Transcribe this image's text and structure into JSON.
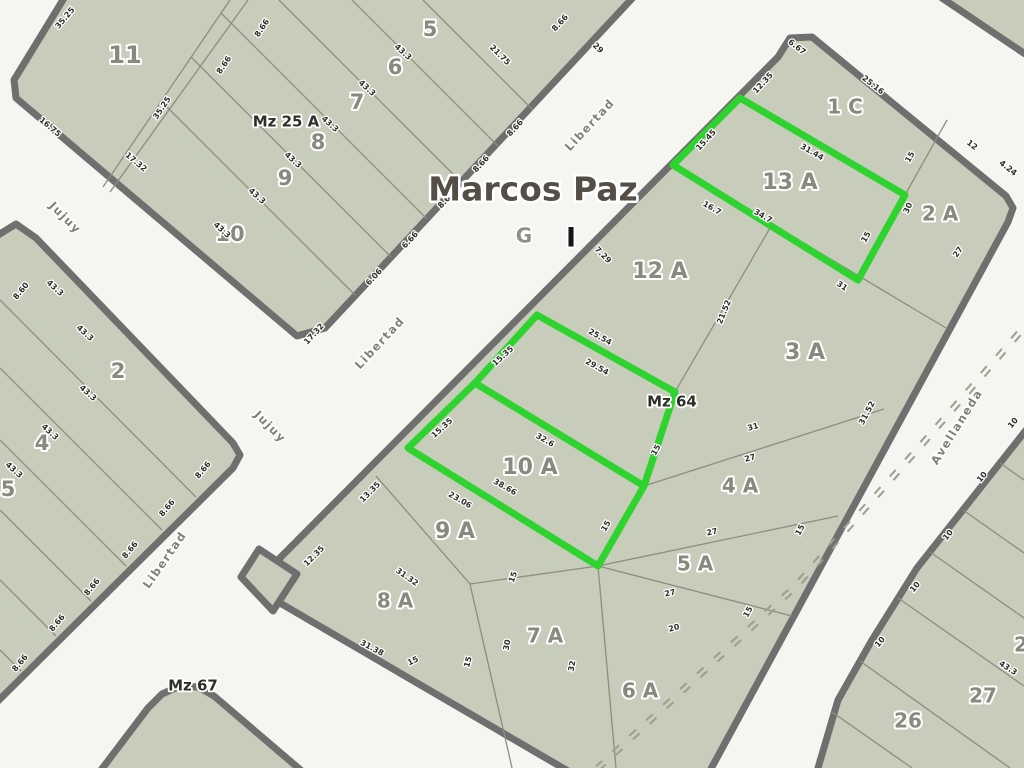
{
  "map_title": {
    "text": "Marcos Paz",
    "x": 533,
    "y": 191
  },
  "overlay_letters": {
    "g": "G",
    "gx": 524,
    "gy": 237,
    "i": "I",
    "ix": 571,
    "iy": 239
  },
  "colors": {
    "street_bg": "#f5f5f2",
    "block_fill": "#c8ccba",
    "block_border": "#6f6f6f",
    "lot_line": "#8d8d81",
    "lot_label": "#868b7d",
    "measurement": "#2e2e28",
    "mz_label": "#2e302a",
    "street_label": "#7e8377",
    "title_color": "#544e46",
    "g_color": "#8f8f8b",
    "i_color": "#161616",
    "green": "#2fd32f",
    "railway": "#9aa08c"
  },
  "blocks": [
    {
      "name": "mz-25a",
      "points": [
        [
          69,
          -10
        ],
        [
          640,
          -10
        ],
        [
          325,
          328
        ],
        [
          297,
          336
        ],
        [
          16,
          98
        ],
        [
          14,
          80
        ]
      ]
    },
    {
      "name": "left-bottom-block",
      "points": [
        [
          -10,
          240
        ],
        [
          16,
          224
        ],
        [
          36,
          238
        ],
        [
          233,
          443
        ],
        [
          240,
          455
        ],
        [
          233,
          468
        ],
        [
          0,
          699
        ],
        [
          -10,
          709
        ]
      ]
    },
    {
      "name": "mz-64",
      "points": [
        [
          778,
          57
        ],
        [
          790,
          38
        ],
        [
          812,
          37
        ],
        [
          1006,
          196
        ],
        [
          1013,
          208
        ],
        [
          1008,
          222
        ],
        [
          706,
          778
        ],
        [
          580,
          778
        ],
        [
          268,
          596
        ],
        [
          258,
          584
        ],
        [
          266,
          572
        ]
      ]
    },
    {
      "name": "mz-67",
      "points": [
        [
          95,
          778
        ],
        [
          148,
          708
        ],
        [
          162,
          694
        ],
        [
          180,
          686
        ],
        [
          198,
          687
        ],
        [
          214,
          696
        ],
        [
          310,
          778
        ]
      ]
    },
    {
      "name": "top-right-corner-block",
      "points": [
        [
          930,
          -10
        ],
        [
          1034,
          -10
        ],
        [
          1034,
          60
        ]
      ]
    },
    {
      "name": "bottom-right-block",
      "points": [
        [
          1034,
          420
        ],
        [
          917,
          568
        ],
        [
          872,
          640
        ],
        [
          838,
          700
        ],
        [
          818,
          768
        ],
        [
          814,
          778
        ],
        [
          1034,
          778
        ]
      ]
    },
    {
      "name": "street-fork-sliver",
      "points": [
        [
          259,
          549
        ],
        [
          297,
          574
        ],
        [
          273,
          611
        ],
        [
          241,
          577
        ]
      ]
    }
  ],
  "lot_lines": [
    [
      230,
      0,
      103,
      187
    ],
    [
      248,
      0,
      110,
      192
    ],
    [
      423,
      0,
      533,
      110
    ],
    [
      352,
      0,
      498,
      146
    ],
    [
      279,
      0,
      462,
      183
    ],
    [
      221,
      13,
      427,
      219
    ],
    [
      191,
      57,
      391,
      257
    ],
    [
      161,
      101,
      355,
      295
    ],
    [
      0,
      300,
      196,
      497
    ],
    [
      0,
      368,
      162,
      530
    ],
    [
      0,
      440,
      126,
      566
    ],
    [
      0,
      510,
      91,
      601
    ],
    [
      0,
      580,
      56,
      636
    ],
    [
      0,
      650,
      21,
      671
    ],
    [
      673,
      165,
      946,
      328
    ],
    [
      740,
      98,
      673,
      165
    ],
    [
      740,
      98,
      905,
      195
    ],
    [
      905,
      195,
      858,
      280
    ],
    [
      947,
      120,
      905,
      195
    ],
    [
      770,
      228,
      675,
      392
    ],
    [
      537,
      315,
      675,
      392
    ],
    [
      675,
      392,
      644,
      486
    ],
    [
      475,
      383,
      644,
      486
    ],
    [
      537,
      315,
      408,
      448
    ],
    [
      408,
      448,
      598,
      566
    ],
    [
      644,
      486,
      598,
      566
    ],
    [
      644,
      486,
      884,
      409
    ],
    [
      598,
      566,
      838,
      516
    ],
    [
      598,
      566,
      792,
      616
    ],
    [
      376,
      476,
      470,
      584
    ],
    [
      470,
      584,
      598,
      566
    ],
    [
      470,
      584,
      512,
      768
    ],
    [
      598,
      566,
      616,
      768
    ],
    [
      1000,
      463,
      1034,
      487
    ],
    [
      963,
      510,
      1034,
      560
    ],
    [
      930,
      552,
      1034,
      625
    ],
    [
      898,
      598,
      1034,
      693
    ],
    [
      860,
      661,
      1010,
      768
    ],
    [
      832,
      712,
      912,
      768
    ]
  ],
  "green_highlight": {
    "polygons": [
      [
        [
          740,
          98
        ],
        [
          905,
          195
        ],
        [
          858,
          280
        ],
        [
          673,
          165
        ]
      ],
      [
        [
          537,
          315
        ],
        [
          675,
          392
        ],
        [
          644,
          486
        ],
        [
          598,
          566
        ],
        [
          408,
          448
        ],
        [
          475,
          383
        ]
      ]
    ],
    "segments": [
      [
        475,
        383,
        644,
        486
      ]
    ]
  },
  "railway": {
    "points": [
      [
        1034,
        316
      ],
      [
        923,
        443
      ],
      [
        795,
        587
      ],
      [
        598,
        768
      ]
    ]
  },
  "labels": {
    "mz": [
      {
        "t": "Mz 25 A",
        "x": 286,
        "y": 122
      },
      {
        "t": "Mz 64",
        "x": 672,
        "y": 402
      },
      {
        "t": "Mz 67",
        "x": 193,
        "y": 686
      }
    ],
    "lots": [
      {
        "t": "11",
        "x": 125,
        "y": 56,
        "s": 24
      },
      {
        "t": "5",
        "x": 430,
        "y": 30,
        "s": 21
      },
      {
        "t": "6",
        "x": 395,
        "y": 68,
        "s": 21
      },
      {
        "t": "7",
        "x": 357,
        "y": 103,
        "s": 21
      },
      {
        "t": "8",
        "x": 318,
        "y": 143,
        "s": 21
      },
      {
        "t": "9",
        "x": 285,
        "y": 179,
        "s": 21
      },
      {
        "t": "10",
        "x": 230,
        "y": 235,
        "s": 21
      },
      {
        "t": "2",
        "x": 118,
        "y": 372,
        "s": 21
      },
      {
        "t": "4",
        "x": 42,
        "y": 444,
        "s": 21
      },
      {
        "t": "5",
        "x": 8,
        "y": 490,
        "s": 21
      },
      {
        "t": "1 C",
        "x": 845,
        "y": 108,
        "s": 20
      },
      {
        "t": "13 A",
        "x": 790,
        "y": 183,
        "s": 22
      },
      {
        "t": "2 A",
        "x": 940,
        "y": 215,
        "s": 20
      },
      {
        "t": "12 A",
        "x": 660,
        "y": 272,
        "s": 22
      },
      {
        "t": "3 A",
        "x": 805,
        "y": 353,
        "s": 22
      },
      {
        "t": "10 A",
        "x": 530,
        "y": 468,
        "s": 22
      },
      {
        "t": "4 A",
        "x": 740,
        "y": 487,
        "s": 20
      },
      {
        "t": "9 A",
        "x": 455,
        "y": 532,
        "s": 22
      },
      {
        "t": "5 A",
        "x": 695,
        "y": 565,
        "s": 20
      },
      {
        "t": "8 A",
        "x": 395,
        "y": 602,
        "s": 20
      },
      {
        "t": "7 A",
        "x": 545,
        "y": 637,
        "s": 20
      },
      {
        "t": "6 A",
        "x": 640,
        "y": 692,
        "s": 20
      },
      {
        "t": "26",
        "x": 908,
        "y": 722,
        "s": 20
      },
      {
        "t": "27",
        "x": 983,
        "y": 697,
        "s": 20
      },
      {
        "t": "2",
        "x": 1021,
        "y": 646,
        "s": 20
      }
    ],
    "streets": [
      {
        "t": "Libertad",
        "x": 590,
        "y": 125,
        "r": -47
      },
      {
        "t": "Libertad",
        "x": 380,
        "y": 343,
        "r": -47
      },
      {
        "t": "Libertad",
        "x": 165,
        "y": 560,
        "r": -55
      },
      {
        "t": "Jujuy",
        "x": 65,
        "y": 218,
        "r": 45
      },
      {
        "t": "Jujuy",
        "x": 270,
        "y": 427,
        "r": 45
      },
      {
        "t": "Avellaneda",
        "x": 957,
        "y": 427,
        "r": -58
      }
    ],
    "measurements": [
      {
        "t": "35.25",
        "x": 65,
        "y": 18,
        "r": -50
      },
      {
        "t": "35.25",
        "x": 162,
        "y": 108,
        "r": -56
      },
      {
        "t": "16.75",
        "x": 50,
        "y": 127,
        "r": 40
      },
      {
        "t": "17.32",
        "x": 136,
        "y": 162,
        "r": 40
      },
      {
        "t": "17.32",
        "x": 314,
        "y": 334,
        "r": -47
      },
      {
        "t": "8.66",
        "x": 262,
        "y": 28,
        "r": -56
      },
      {
        "t": "8.66",
        "x": 224,
        "y": 65,
        "r": -56
      },
      {
        "t": "8.66",
        "x": 560,
        "y": 23,
        "r": -47
      },
      {
        "t": "43.3",
        "x": 403,
        "y": 52,
        "r": 42
      },
      {
        "t": "43.3",
        "x": 367,
        "y": 88,
        "r": 42
      },
      {
        "t": "43.3",
        "x": 330,
        "y": 124,
        "r": 42
      },
      {
        "t": "43.3",
        "x": 293,
        "y": 160,
        "r": 42
      },
      {
        "t": "43.3",
        "x": 257,
        "y": 196,
        "r": 42
      },
      {
        "t": "43.3",
        "x": 222,
        "y": 230,
        "r": 42
      },
      {
        "t": "21.75",
        "x": 500,
        "y": 55,
        "r": 45
      },
      {
        "t": "29",
        "x": 598,
        "y": 48,
        "r": 45
      },
      {
        "t": "8.66",
        "x": 515,
        "y": 128,
        "r": -47
      },
      {
        "t": "8.66",
        "x": 481,
        "y": 164,
        "r": -47
      },
      {
        "t": "8.66",
        "x": 446,
        "y": 200,
        "r": -47
      },
      {
        "t": "6.66",
        "x": 410,
        "y": 240,
        "r": -47
      },
      {
        "t": "6.06",
        "x": 374,
        "y": 277,
        "r": -47
      },
      {
        "t": "8.60",
        "x": 21,
        "y": 291,
        "r": -50
      },
      {
        "t": "43.3",
        "x": 55,
        "y": 288,
        "r": 42
      },
      {
        "t": "43.3",
        "x": 85,
        "y": 333,
        "r": 42
      },
      {
        "t": "43.3",
        "x": 88,
        "y": 393,
        "r": 42
      },
      {
        "t": "43.3",
        "x": 50,
        "y": 432,
        "r": 42
      },
      {
        "t": "43.3",
        "x": 14,
        "y": 470,
        "r": 42
      },
      {
        "t": "8.66",
        "x": 203,
        "y": 470,
        "r": -50
      },
      {
        "t": "8.66",
        "x": 167,
        "y": 508,
        "r": -50
      },
      {
        "t": "8.66",
        "x": 130,
        "y": 550,
        "r": -50
      },
      {
        "t": "8.66",
        "x": 92,
        "y": 587,
        "r": -50
      },
      {
        "t": "8.66",
        "x": 57,
        "y": 623,
        "r": -50
      },
      {
        "t": "8.66",
        "x": 20,
        "y": 663,
        "r": -50
      },
      {
        "t": "6.67",
        "x": 797,
        "y": 47,
        "r": 38
      },
      {
        "t": "12.35",
        "x": 763,
        "y": 83,
        "r": -47
      },
      {
        "t": "25.16",
        "x": 873,
        "y": 85,
        "r": 38
      },
      {
        "t": "15.45",
        "x": 706,
        "y": 140,
        "r": -47
      },
      {
        "t": "31.44",
        "x": 812,
        "y": 152,
        "r": 30
      },
      {
        "t": "15",
        "x": 910,
        "y": 157,
        "r": -60
      },
      {
        "t": "12",
        "x": 972,
        "y": 145,
        "r": 38
      },
      {
        "t": "4.24",
        "x": 1008,
        "y": 168,
        "r": 38
      },
      {
        "t": "30",
        "x": 908,
        "y": 208,
        "r": -65
      },
      {
        "t": "16.7",
        "x": 712,
        "y": 208,
        "r": 30
      },
      {
        "t": "34.7",
        "x": 763,
        "y": 216,
        "r": 30
      },
      {
        "t": "15",
        "x": 866,
        "y": 237,
        "r": -60
      },
      {
        "t": "27",
        "x": 958,
        "y": 252,
        "r": -55
      },
      {
        "t": "7.29",
        "x": 603,
        "y": 255,
        "r": 45
      },
      {
        "t": "31",
        "x": 842,
        "y": 286,
        "r": 33
      },
      {
        "t": "21.52",
        "x": 724,
        "y": 312,
        "r": -68
      },
      {
        "t": "25.54",
        "x": 600,
        "y": 337,
        "r": 29
      },
      {
        "t": "29.54",
        "x": 597,
        "y": 367,
        "r": 29
      },
      {
        "t": "31.52",
        "x": 867,
        "y": 413,
        "r": -62
      },
      {
        "t": "15.35",
        "x": 503,
        "y": 356,
        "r": -42
      },
      {
        "t": "15.35",
        "x": 442,
        "y": 428,
        "r": -42
      },
      {
        "t": "32.6",
        "x": 545,
        "y": 440,
        "r": 30
      },
      {
        "t": "15",
        "x": 656,
        "y": 450,
        "r": -60
      },
      {
        "t": "31",
        "x": 753,
        "y": 427,
        "r": -15
      },
      {
        "t": "27",
        "x": 750,
        "y": 458,
        "r": -15
      },
      {
        "t": "23.06",
        "x": 460,
        "y": 500,
        "r": 30
      },
      {
        "t": "38.66",
        "x": 505,
        "y": 487,
        "r": 30
      },
      {
        "t": "15",
        "x": 606,
        "y": 526,
        "r": -60
      },
      {
        "t": "27",
        "x": 712,
        "y": 532,
        "r": -12
      },
      {
        "t": "15",
        "x": 800,
        "y": 530,
        "r": -62
      },
      {
        "t": "13.35",
        "x": 370,
        "y": 492,
        "r": -45
      },
      {
        "t": "12.35",
        "x": 314,
        "y": 556,
        "r": -45
      },
      {
        "t": "31.32",
        "x": 407,
        "y": 577,
        "r": 35
      },
      {
        "t": "15",
        "x": 513,
        "y": 577,
        "r": -70
      },
      {
        "t": "27",
        "x": 670,
        "y": 593,
        "r": -12
      },
      {
        "t": "31.38",
        "x": 372,
        "y": 648,
        "r": 28
      },
      {
        "t": "15",
        "x": 468,
        "y": 662,
        "r": -75
      },
      {
        "t": "15",
        "x": 413,
        "y": 661,
        "r": -25
      },
      {
        "t": "30",
        "x": 507,
        "y": 645,
        "r": -80
      },
      {
        "t": "32",
        "x": 572,
        "y": 666,
        "r": -80
      },
      {
        "t": "20",
        "x": 674,
        "y": 628,
        "r": -15
      },
      {
        "t": "15",
        "x": 748,
        "y": 612,
        "r": -62
      },
      {
        "t": "10",
        "x": 1013,
        "y": 423,
        "r": -50
      },
      {
        "t": "10",
        "x": 982,
        "y": 477,
        "r": -50
      },
      {
        "t": "10",
        "x": 948,
        "y": 535,
        "r": -50
      },
      {
        "t": "10",
        "x": 915,
        "y": 587,
        "r": -50
      },
      {
        "t": "10",
        "x": 880,
        "y": 642,
        "r": -50
      },
      {
        "t": "43.3",
        "x": 1008,
        "y": 668,
        "r": 33
      }
    ]
  }
}
